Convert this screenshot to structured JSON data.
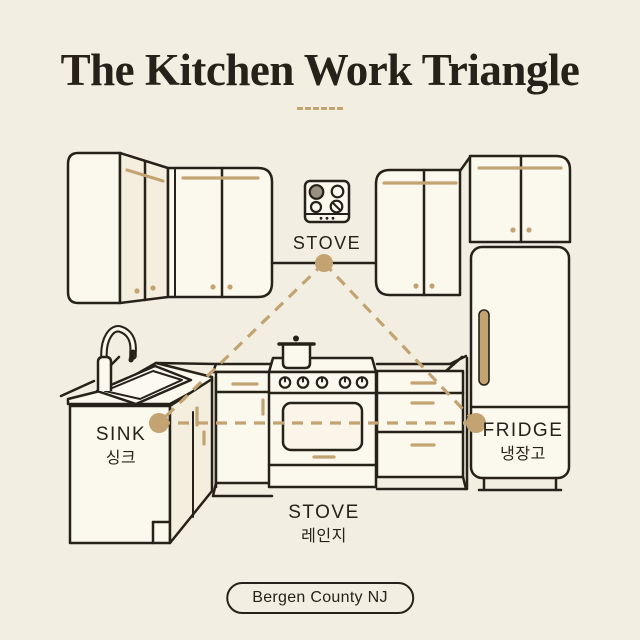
{
  "title": "The Kitchen Work Triangle",
  "stations": {
    "stove_wall": {
      "label": "STOVE"
    },
    "sink": {
      "label": "SINK",
      "label_ko": "싱크"
    },
    "range": {
      "label": "STOVE",
      "label_ko": "레인지"
    },
    "fridge": {
      "label": "FRIDGE",
      "label_ko": "냉장고"
    }
  },
  "badge": {
    "text": "Bergen County NJ"
  },
  "icons": {
    "cooktop": "four-burner-cooktop",
    "pot": "stock-pot-with-lid",
    "faucet": "gooseneck-faucet",
    "vertex_marker": "filled-gold-dot",
    "triangle": "dashed-gold-triangle"
  },
  "colors": {
    "background": "#F3EEE2",
    "line": "#262219",
    "gold": "#C2A371",
    "panel": "#FBF8EE",
    "panel_shade": "#F4EEDE",
    "window": "#FAF5E8",
    "burner": "#99907F",
    "basin": "#FCF9F0"
  }
}
